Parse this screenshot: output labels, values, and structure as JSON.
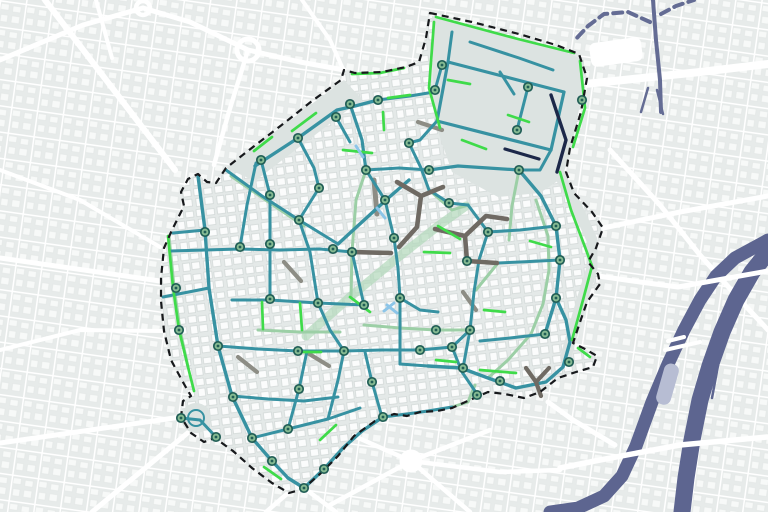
{
  "meta": {
    "canvas": {
      "w": 768,
      "h": 512
    },
    "node_style": {
      "r": 4.2,
      "dot_r": 1.4,
      "ring_w": 1.7
    }
  },
  "palette": {
    "bgOut": "#edf0f0",
    "blockOut": "#e7ebea",
    "bldgOut": "#f7f9f8",
    "bgIn": "#e4e9e8",
    "bldgIn": "#fbfcfc",
    "bldgInStroke": "#ccd3d2",
    "plain": "#dce3e1",
    "t": "#3792a2",
    "p": "#9ccfa6",
    "band": "#b2d8ba",
    "g": "#3fdb4a",
    "gr": "#8d8d85",
    "dk": "#6f6a63",
    "n": "#1c2849",
    "lb": "#8cc5e8",
    "w": "#ffffff",
    "r": "#646c94",
    "rv": "#5d6590",
    "basin": "#b7bdd3",
    "bnd": "#17191c",
    "nodeRing": "#215e56",
    "nodeFill": "#85ba92"
  },
  "boundary_d": "M430 13 L472 22 L519 34 L556 45 L579 54 L587 78 L581 112 L570 148 L566 172 L574 193 L592 212 L603 228 L596 248 L588 262 L598 274 L600 284 L587 302 L579 325 L573 343 L585 349 L597 356 L593 367 L576 372 L558 378 L540 392 L524 398 L505 394 L488 392 L470 400 L452 408 L437 411 L420 412 L407 416 L394 414 L375 421 L354 436 L338 456 L321 473 L303 489 L289 493 L272 483 L252 468 L233 451 L215 438 L204 442 L191 433 L181 417 L183 401 L191 396 L184 384 L171 360 L164 331 L161 301 L161 278 L164 248 L172 230 L184 206 L181 192 L188 179 L198 174 L207 182 L216 183 L226 168 L253 147 L283 124 L312 101 L341 80 L344 70 L355 73 L382 72 L406 67 L419 62 L426 38 Z",
  "layers": [
    {
      "name": "basemap-outside",
      "item_name": "basemap-tile",
      "items": [
        {
          "t": "rect",
          "x": 0,
          "y": 0,
          "wd": 768,
          "h": 512,
          "f": "url(#outTex)"
        }
      ]
    },
    {
      "name": "outside-roads",
      "item_name": "road",
      "c": "w",
      "w": 5,
      "items": [
        {
          "p": "45,0 175,170",
          "w": 6
        },
        {
          "p": "0,60 83,25 143,8"
        },
        {
          "p": "143,8 190,22 248,50"
        },
        {
          "t": "c",
          "cx": 248,
          "cy": 50,
          "r": 11,
          "f": "none",
          "c": "w",
          "w": 5,
          "n": "roundabout"
        },
        {
          "t": "c",
          "cx": 143,
          "cy": 8,
          "r": 7,
          "f": "none",
          "c": "w",
          "w": 4.5,
          "n": "roundabout"
        },
        {
          "p": "248,50 300,62 344,70"
        },
        {
          "p": "248,50 228,115 214,165",
          "w": 4.5
        },
        {
          "p": "96,0 112,58",
          "w": 4
        },
        {
          "p": "0,258 160,281"
        },
        {
          "p": "0,443 181,417"
        },
        {
          "p": "92,512 190,431"
        },
        {
          "p": "288,493 266,512",
          "w": 4.5
        },
        {
          "p": "304,488 336,512",
          "w": 4.5
        },
        {
          "p": "585,84 700,72 768,64",
          "w": 8
        },
        {
          "p": "603,228 680,212 768,196"
        },
        {
          "p": "610,150 660,205 700,255 740,300 768,330"
        },
        {
          "t": "c",
          "cx": 411,
          "cy": 461,
          "r": 9,
          "f": "w",
          "n": "roundabout"
        },
        {
          "p": "411,461 340,430",
          "w": 4.5
        },
        {
          "p": "411,461 330,505",
          "w": 4.5
        },
        {
          "p": "411,461 470,512",
          "w": 4.5
        },
        {
          "p": "411,461 490,430",
          "w": 4.5
        },
        {
          "p": "411,461 500,472 560,470",
          "w": 4.5
        },
        {
          "p": "0,170 80,200 160,247",
          "w": 4
        },
        {
          "p": "0,350 80,330 163,331",
          "w": 4
        },
        {
          "p": "302,0 330,40 343,69",
          "w": 4
        }
      ]
    },
    {
      "name": "railway",
      "item_name": "rail-line",
      "c": "r",
      "w": 4,
      "items": [
        {
          "p": "653,0 656,40 660,80 661,112"
        },
        {
          "p": "650,22 628,12 604,14 588,26 575,40",
          "dash": "9 6"
        },
        {
          "p": "661,14 676,6 694,0",
          "dash": "9 6"
        },
        {
          "p": "648,88 641,112",
          "w": 2.5
        },
        {
          "p": "657,90 663,114",
          "w": 2.5
        },
        {
          "t": "rect",
          "x": 590,
          "y": 40,
          "wd": 52,
          "h": 24,
          "rx": 6,
          "f": "w",
          "tr": "rotate(-8 616 52)",
          "n": "station-building"
        }
      ]
    },
    {
      "name": "river",
      "item_name": "river-channel",
      "c": "rv",
      "items": [
        {
          "p": "768,240 735,258 716,276 700,300 684,330 668,364 652,402 636,446 622,476 604,496 578,508 550,512",
          "w": 13
        },
        {
          "p": "768,252 752,272 736,300 722,332 710,366 700,400 692,440 686,478 682,512",
          "w": 17
        },
        {
          "p": "722,344 712,398",
          "w": 2.5
        },
        {
          "t": "rect",
          "x": 660,
          "y": 363,
          "wd": 15,
          "h": 42,
          "rx": 7,
          "f": "basin",
          "tr": "rotate(16 667 384)",
          "n": "island-basin"
        }
      ]
    },
    {
      "name": "bridges",
      "item_name": "bridge",
      "c": "w",
      "items": [
        {
          "p": "598,276 640,282 678,287 768,271",
          "w": 5
        },
        {
          "p": "665,350 700,342",
          "w": 4
        },
        {
          "p": "668,341 684,337",
          "w": 4
        },
        {
          "p": "560,468 600,460 680,445 767,437",
          "w": 5.5
        },
        {
          "p": "548,402 573,420 615,445",
          "w": 5
        }
      ]
    },
    {
      "name": "study-area",
      "item_name": "study-area-fill",
      "items": [
        {
          "t": "path",
          "d": "BOUNDARY",
          "f": "url(#inTex)",
          "n": "study-area-fill"
        },
        {
          "t": "poly",
          "p": "226,168 344,80 362,99 255,181",
          "f": "plain",
          "n": "open-strip"
        },
        {
          "t": "poly",
          "p": "432,16 556,48 584,60 584,84 571,150 562,178 540,193 498,197 452,172 434,120",
          "f": "plain",
          "n": "park-area"
        },
        {
          "p": "560,176 576,205 592,240 592,268 582,300 572,335 566,356",
          "w": 11,
          "c": "plain",
          "n": "open-strip"
        },
        {
          "t": "c",
          "cx": 196,
          "cy": 418,
          "r": 15,
          "f": "plain",
          "n": "citadel-mound"
        },
        {
          "t": "c",
          "cx": 196,
          "cy": 418,
          "r": 8,
          "f": "none",
          "c": "t",
          "w": 2,
          "n": "citadel-ring"
        }
      ]
    },
    {
      "name": "street-network",
      "item_name": "street-segment",
      "w": 3,
      "items": [
        {
          "p": "306,336 350,297 396,259 438,226 466,206",
          "c": "band",
          "w": 9,
          "o": 0.7
        },
        {
          "p": "231,176 267,201 304,226",
          "c": "p"
        },
        {
          "p": "258,330 300,332 340,332",
          "c": "p"
        },
        {
          "p": "364,325 400,328 436,330 470,330",
          "c": "p"
        },
        {
          "p": "536,200 548,236 549,270 543,304 531,334",
          "c": "p"
        },
        {
          "p": "519,170 512,206 509,240",
          "c": "p"
        },
        {
          "p": "366,170 356,200 352,252",
          "c": "p"
        },
        {
          "p": "352,252 351,297",
          "c": "p"
        },
        {
          "p": "429,190 452,210 468,205",
          "c": "p"
        },
        {
          "p": "475,385 468,402 452,407",
          "c": "p"
        },
        {
          "p": "531,334 508,360 488,378",
          "c": "p"
        },
        {
          "p": "498,263 476,290",
          "c": "p"
        },
        {
          "p": "169,236 174,287 180,330 188,367",
          "c": "p"
        },
        {
          "p": "284,262 301,281",
          "c": "gr",
          "w": 4.2
        },
        {
          "p": "306,352 329,366",
          "c": "gr",
          "w": 4.2
        },
        {
          "p": "238,357 257,372",
          "c": "gr",
          "w": 4.2
        },
        {
          "p": "418,122 442,130",
          "c": "gr",
          "w": 4.2
        },
        {
          "p": "463,292 476,310",
          "c": "gr",
          "w": 4.2
        },
        {
          "p": "374,180 377,214",
          "c": "gr",
          "w": 5
        },
        {
          "p": "198,176 205,230 209,288 218,346 232,396 252,438 272,461 288,478",
          "c": "t",
          "w": 3.4
        },
        {
          "p": "288,478 304,488 324,469 343,448 362,431 383,417",
          "c": "t",
          "w": 3.4
        },
        {
          "p": "173,233 205,230",
          "c": "t"
        },
        {
          "p": "163,297 209,288",
          "c": "t"
        },
        {
          "p": "218,346 258,349 298,351 341,351",
          "c": "t"
        },
        {
          "p": "232,396 268,399 304,401 338,397",
          "c": "t"
        },
        {
          "p": "252,438 288,429 328,419 360,408",
          "c": "t"
        },
        {
          "p": "288,429 299,389 307,351",
          "c": "t"
        },
        {
          "p": "328,419 338,380 344,351",
          "c": "t"
        },
        {
          "p": "255,166 298,138 337,110 355,106 378,100",
          "c": "t",
          "w": 3.4
        },
        {
          "p": "256,163 247,205 240,247",
          "c": "t"
        },
        {
          "p": "170,251 240,249 280,250 320,249 352,252",
          "c": "t"
        },
        {
          "p": "261,160 270,195 270,244 270,299",
          "c": "t"
        },
        {
          "p": "232,300 270,300 318,303 364,305",
          "c": "t"
        },
        {
          "p": "298,138 314,168 319,188",
          "c": "t"
        },
        {
          "p": "319,188 299,220 310,252 318,303",
          "c": "t"
        },
        {
          "p": "318,303 330,330 344,351",
          "c": "t"
        },
        {
          "p": "364,305 352,252",
          "c": "t"
        },
        {
          "p": "226,170 262,196 299,220",
          "c": "t"
        },
        {
          "p": "299,220 338,244",
          "c": "t"
        },
        {
          "p": "338,244 362,222 386,200 409,180",
          "c": "t",
          "w": 3.4
        },
        {
          "p": "350,104 362,140 366,170",
          "c": "t",
          "w": 3.2
        },
        {
          "p": "336,117 350,142",
          "c": "t"
        },
        {
          "p": "366,170 399,168 429,170",
          "c": "t"
        },
        {
          "p": "378,100 410,96 434,92",
          "c": "t"
        },
        {
          "p": "409,143 421,168 429,190",
          "c": "t"
        },
        {
          "p": "429,170 458,166 488,168 519,170",
          "c": "t",
          "w": 3.2
        },
        {
          "p": "366,170 385,200",
          "c": "t"
        },
        {
          "p": "385,200 394,238 398,268 400,298",
          "c": "t"
        },
        {
          "p": "400,298 400,330 400,364",
          "c": "t"
        },
        {
          "p": "400,298 420,310 438,312",
          "c": "t"
        },
        {
          "p": "519,170 541,196 556,226 560,260 556,298 545,334",
          "c": "t",
          "w": 3.4
        },
        {
          "p": "556,298 566,320 570,342 563,367 546,382 516,388 488,378 461,368 428,366",
          "c": "t",
          "w": 3.4
        },
        {
          "p": "470,330 463,368",
          "c": "t"
        },
        {
          "p": "344,351 382,350 420,350 452,347",
          "c": "t"
        },
        {
          "p": "452,347 470,330",
          "c": "t"
        },
        {
          "p": "452,347 462,372 477,394",
          "c": "t"
        },
        {
          "p": "383,417 407,414 428,411 452,407",
          "c": "t"
        },
        {
          "p": "400,364 428,366",
          "c": "t"
        },
        {
          "p": "382,417 372,382 365,352",
          "c": "t"
        },
        {
          "p": "488,232 479,260 474,292 470,330",
          "c": "t"
        },
        {
          "p": "556,226 520,230 488,232",
          "c": "t"
        },
        {
          "p": "560,260 520,262 498,263",
          "c": "t"
        },
        {
          "p": "429,190 449,203 468,205",
          "c": "t"
        },
        {
          "p": "468,205 488,232",
          "c": "t"
        },
        {
          "p": "545,334 510,338 480,341",
          "c": "t"
        },
        {
          "p": "181,418 200,420 216,437",
          "c": "t"
        },
        {
          "p": "448,62 564,92",
          "c": "t",
          "w": 3.2
        },
        {
          "p": "564,92 551,150",
          "c": "t",
          "w": 3.2
        },
        {
          "p": "551,150 437,121",
          "c": "t",
          "w": 3.2
        },
        {
          "p": "437,121 448,62",
          "c": "t",
          "w": 3.2
        },
        {
          "p": "452,32 448,62",
          "c": "t"
        },
        {
          "p": "470,42 519,58 553,70",
          "c": "t"
        },
        {
          "p": "500,72 514,94",
          "c": "t"
        },
        {
          "p": "442,65 435,90",
          "c": "t"
        },
        {
          "p": "528,87 517,130",
          "c": "t"
        },
        {
          "p": "551,150 540,170 519,170",
          "c": "t"
        },
        {
          "p": "437,121 420,140 409,143",
          "c": "t"
        },
        {
          "p": "397,182 421,196 443,187",
          "c": "dk",
          "w": 4.6
        },
        {
          "p": "421,196 417,227 399,247",
          "c": "dk",
          "w": 4.6
        },
        {
          "p": "435,229 465,236 467,261 497,263",
          "c": "dk",
          "w": 4.6
        },
        {
          "p": "465,236 486,216 507,219",
          "c": "dk",
          "w": 4.6
        },
        {
          "p": "352,252 391,253",
          "c": "dk",
          "w": 4.6
        },
        {
          "p": "526,368 536,382 541,396",
          "c": "dk",
          "w": 4.2
        },
        {
          "p": "536,382 549,368",
          "c": "dk",
          "w": 4.2
        },
        {
          "p": "551,95 566,140 557,172",
          "c": "n",
          "w": 3.4
        },
        {
          "p": "505,149 539,159",
          "c": "n",
          "w": 3.2
        },
        {
          "p": "434,22 429,88 440,128",
          "c": "g",
          "w": 2.7
        },
        {
          "p": "436,17 518,39 574,53",
          "c": "g",
          "w": 2.7
        },
        {
          "p": "580,61 585,108 573,147",
          "c": "g",
          "w": 2.7
        },
        {
          "p": "560,172 571,210 585,247 592,266 583,300 572,340",
          "c": "g",
          "w": 2.7
        },
        {
          "p": "578,348 590,357",
          "c": "g",
          "w": 2.7
        },
        {
          "p": "168,236 173,287 179,330 188,367 194,391",
          "c": "g",
          "w": 2.7
        },
        {
          "p": "343,150 372,153",
          "c": "g",
          "w": 2.7
        },
        {
          "p": "383,112 384,130",
          "c": "g",
          "w": 2.7
        },
        {
          "p": "424,252 450,253",
          "c": "g",
          "w": 2.7
        },
        {
          "p": "300,303 302,330",
          "c": "g",
          "w": 2.7
        },
        {
          "p": "262,302 263,329",
          "c": "g",
          "w": 2.7
        },
        {
          "p": "350,297 370,312",
          "c": "g",
          "w": 2.7
        },
        {
          "p": "438,226 460,239",
          "c": "g",
          "w": 2.7
        },
        {
          "p": "300,352 321,352",
          "c": "g",
          "w": 2.7
        },
        {
          "p": "388,98 410,95",
          "c": "g",
          "w": 2.7
        },
        {
          "p": "448,80 470,84",
          "c": "g",
          "w": 2.7
        },
        {
          "p": "508,115 529,122",
          "c": "g",
          "w": 2.7
        },
        {
          "p": "436,360 456,362",
          "c": "g",
          "w": 2.7
        },
        {
          "p": "480,370 516,373",
          "c": "g",
          "w": 2.7
        },
        {
          "p": "320,440 336,425",
          "c": "g",
          "w": 2.7
        },
        {
          "p": "264,467 281,479",
          "c": "g",
          "w": 2.7
        },
        {
          "p": "484,310 505,312",
          "c": "g",
          "w": 2.7
        },
        {
          "p": "530,241 551,247",
          "c": "g",
          "w": 2.7
        },
        {
          "p": "292,131 316,113",
          "c": "g",
          "w": 2.7
        },
        {
          "p": "254,151 272,137",
          "c": "g",
          "w": 2.7
        },
        {
          "p": "462,140 486,149",
          "c": "g",
          "w": 2.7
        },
        {
          "p": "352,74 380,73 404,68",
          "c": "g",
          "w": 2.7
        },
        {
          "p": "377,208 385,218",
          "c": "lb"
        },
        {
          "p": "387,305 397,313",
          "c": "lb"
        },
        {
          "p": "384,311 394,303",
          "c": "lb"
        },
        {
          "p": "356,146 363,157",
          "c": "lb"
        }
      ]
    },
    {
      "name": "study-area-boundary",
      "item_name": "boundary-dashed-line",
      "items": [
        {
          "t": "path",
          "d": "BOUNDARY",
          "f": "none",
          "c": "bnd",
          "w": 2.2,
          "dash": "7 5"
        }
      ]
    }
  ],
  "nodes": [
    [
      350,
      104
    ],
    [
      336,
      117
    ],
    [
      298,
      138
    ],
    [
      261,
      160
    ],
    [
      270,
      195
    ],
    [
      319,
      188
    ],
    [
      299,
      220
    ],
    [
      240,
      247
    ],
    [
      270,
      244
    ],
    [
      333,
      249
    ],
    [
      352,
      252
    ],
    [
      385,
      200
    ],
    [
      394,
      238
    ],
    [
      366,
      170
    ],
    [
      429,
      170
    ],
    [
      409,
      143
    ],
    [
      378,
      100
    ],
    [
      442,
      65
    ],
    [
      435,
      90
    ],
    [
      528,
      87
    ],
    [
      517,
      130
    ],
    [
      582,
      100
    ],
    [
      519,
      170
    ],
    [
      205,
      232
    ],
    [
      176,
      288
    ],
    [
      179,
      330
    ],
    [
      218,
      346
    ],
    [
      181,
      418
    ],
    [
      216,
      437
    ],
    [
      233,
      397
    ],
    [
      252,
      438
    ],
    [
      272,
      461
    ],
    [
      304,
      488
    ],
    [
      324,
      469
    ],
    [
      288,
      429
    ],
    [
      299,
      389
    ],
    [
      372,
      382
    ],
    [
      344,
      351
    ],
    [
      298,
      351
    ],
    [
      318,
      303
    ],
    [
      270,
      299
    ],
    [
      364,
      305
    ],
    [
      400,
      298
    ],
    [
      436,
      330
    ],
    [
      470,
      330
    ],
    [
      420,
      350
    ],
    [
      452,
      347
    ],
    [
      463,
      368
    ],
    [
      477,
      395
    ],
    [
      500,
      381
    ],
    [
      569,
      362
    ],
    [
      545,
      334
    ],
    [
      556,
      298
    ],
    [
      560,
      260
    ],
    [
      556,
      226
    ],
    [
      488,
      232
    ],
    [
      467,
      261
    ],
    [
      449,
      203
    ],
    [
      383,
      417
    ]
  ]
}
